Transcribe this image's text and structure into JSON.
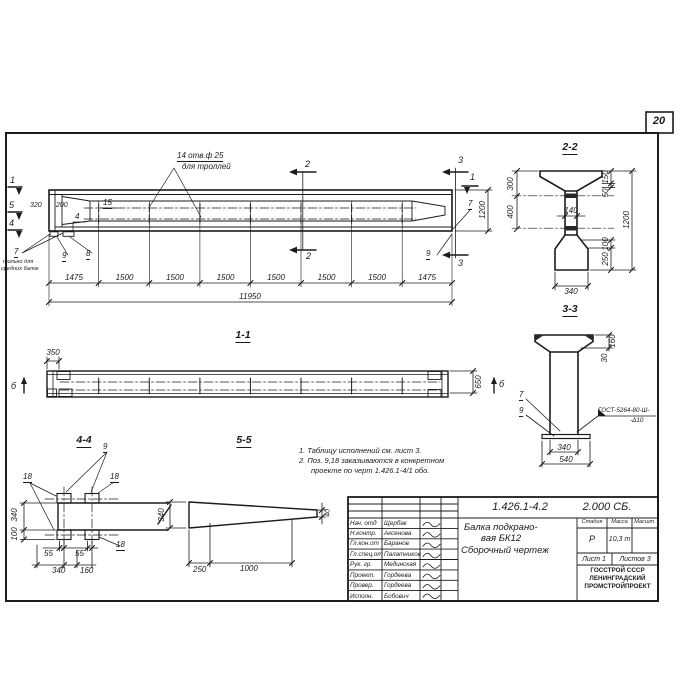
{
  "page": {
    "number": "20"
  },
  "main_view": {
    "mark_1": "1",
    "mark_5": "5",
    "mark_4": "4",
    "mark_1_right": "1",
    "section_2": "2",
    "section_3": "3",
    "hole_note_line1": "14 отв.ф 25",
    "hole_note_line2": "для троллей",
    "dim_320": "320",
    "dim_200": "200",
    "pos_15": "15",
    "pos_4": "4",
    "pos_7": "7",
    "pos_7_note_line1": "только для",
    "pos_7_note_line2": "средних балок",
    "pos_9": "9",
    "pos_8": "8",
    "pos_7_right": "7",
    "pos_9_right": "9",
    "segment_dims": [
      "1475",
      "1500",
      "1500",
      "1500",
      "1500",
      "1500",
      "1500",
      "1475"
    ],
    "total_dim": "11950",
    "dim_1200": "1200"
  },
  "section_2_2": {
    "title": "2-2",
    "dim_300": "300",
    "dim_400": "400",
    "dim_140": "140",
    "dim_150": "150",
    "dim_50": "50",
    "dim_1200": "1200",
    "dim_100": "100",
    "dim_250": "250",
    "dim_340": "340"
  },
  "section_3_3": {
    "title": "3-3",
    "dim_160": "160",
    "dim_30": "30",
    "pos_7": "7",
    "pos_9": "9",
    "weld_line1": "ГОСТ-5264-80-Ш-",
    "weld_line2": "-Δ10",
    "dim_340": "340",
    "dim_540": "540"
  },
  "view_1_1": {
    "title": "1-1",
    "dim_350": "350",
    "dim_650": "650",
    "mark_left": "б",
    "mark_right": "б"
  },
  "section_4_4": {
    "title": "4-4",
    "pos_9": "9",
    "pos_18_top_left": "18",
    "pos_18_top_right": "18",
    "pos_18_bottom": "18",
    "dim_340_side": "340",
    "dim_100": "100",
    "dim_55_left": "55",
    "dim_55_right": "55",
    "dim_340_bottom": "340",
    "dim_160": "160"
  },
  "view_5_5": {
    "title": "5-5",
    "dim_340": "340",
    "dim_250": "250",
    "dim_1000": "1000",
    "dim_40": "40"
  },
  "notes": {
    "line1": "1. Таблицу исполнений см. лист 3.",
    "line2": "2. Поз. 9,18 заказываются в конкретном",
    "line3": "проекте по черт 1.426.1-4/1 обо."
  },
  "title_block": {
    "doc_number": "1.426.1-4.2",
    "doc_code": "2.000 СБ.",
    "title_line1": "Балка подкрано-",
    "title_line2": "вая БК12",
    "title_line3": "Сборочный чертеж",
    "col_stage": "Стадия",
    "col_mass": "Масса",
    "col_scale": "Масшт.",
    "stage": "Р",
    "mass": "10,3 т",
    "sheet": "Лист 1",
    "sheets": "Листов 3",
    "org_line1": "ГОССТРОЙ СССР",
    "org_line2": "ЛЕНИНГРАДСКИЙ",
    "org_line3": "ПРОМСТРОЙПРОЕКТ",
    "rows": [
      {
        "role": "Нач. отд",
        "name": "Щербак"
      },
      {
        "role": "Н.контр.",
        "name": "Аксенова"
      },
      {
        "role": "Гл.кон.от",
        "name": "Баранов"
      },
      {
        "role": "Гл.спец.от",
        "name": "Палатников"
      },
      {
        "role": "Рук. гр.",
        "name": "Мединская"
      },
      {
        "role": "Проект.",
        "name": "Гордеева"
      },
      {
        "role": "Провер.",
        "name": "Гордеева"
      },
      {
        "role": "Исполн.",
        "name": "Бобович"
      }
    ]
  }
}
